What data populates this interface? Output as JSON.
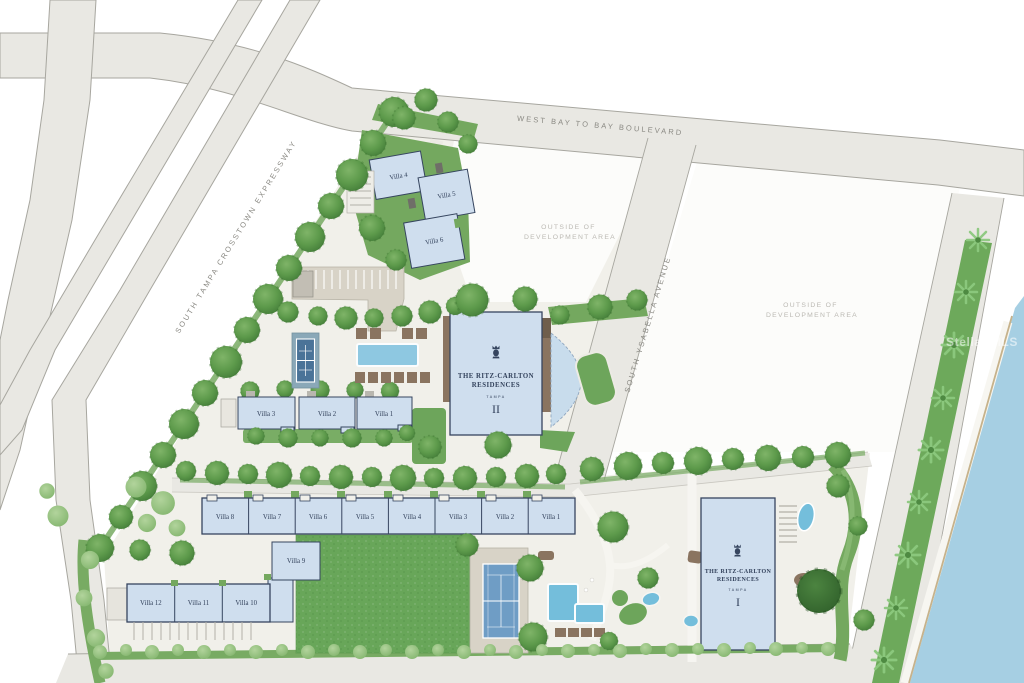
{
  "roads": {
    "boulevard": "WEST BAY TO BAY BOULEVARD",
    "expressway": "SOUTH TAMPA CROSSTOWN EXPRESSWAY",
    "avenue": "SOUTH YSABELLA AVENUE"
  },
  "parcels": {
    "line1": "OUTSIDE OF",
    "line2": "DEVELOPMENT AREA"
  },
  "towers": {
    "brand1": "THE RITZ-CARLTON",
    "brand2": "RESIDENCES",
    "city": "TAMPA",
    "numeral_i": "I",
    "numeral_ii": "II"
  },
  "villas": {
    "north": [
      "Villa 4",
      "Villa 5",
      "Villa 6"
    ],
    "mid": [
      "Villa 3",
      "Villa 2",
      "Villa 1"
    ],
    "row": [
      "Villa 8",
      "Villa 7",
      "Villa 6",
      "Villa 5",
      "Villa 4",
      "Villa 3",
      "Villa 2",
      "Villa 1"
    ],
    "nine": "Villa 9",
    "south": [
      "Villa 12",
      "Villa 11",
      "Villa 10"
    ]
  },
  "watermark": "Stellar MLS",
  "colors": {
    "road": "#e9e8e3",
    "ground": "#f1f0ea",
    "parcel_white": "#fcfcfa",
    "building_fill": "#cfdeee",
    "building_stroke": "#36455f",
    "tree_green": "#5d9a4b",
    "hedge_green": "#78ab63",
    "lawn": "#68a659",
    "water": "#a6cfe3",
    "pool": "#74bedb",
    "tan": "#d8d3c7",
    "brown": "#8a7460",
    "label_navy": "#33425c",
    "label_gray": "#bbb9b3"
  }
}
